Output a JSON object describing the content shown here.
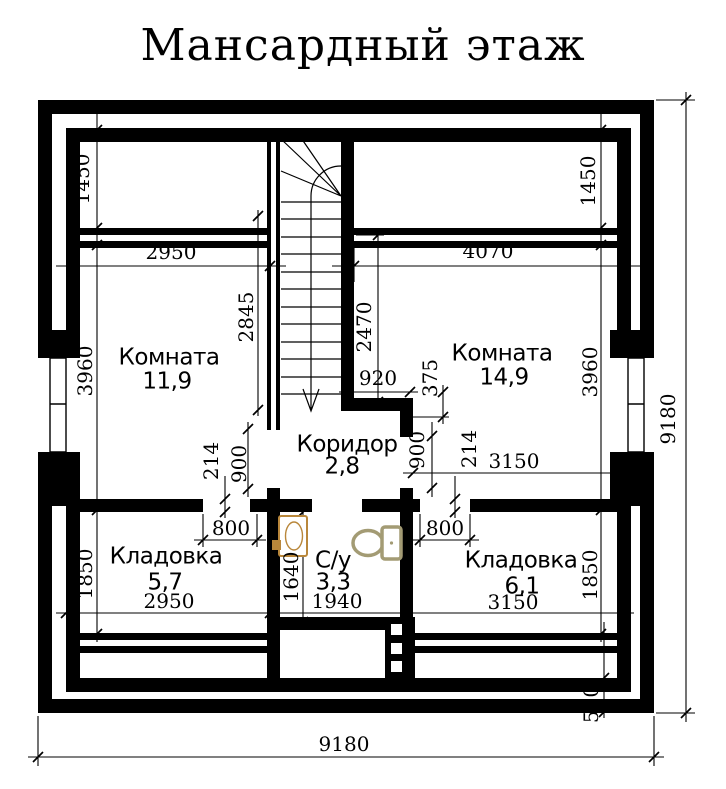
{
  "title": "Мансардный этаж",
  "rooms": {
    "room_left": {
      "name": "Комната",
      "area": "11,9"
    },
    "room_right": {
      "name": "Комната",
      "area": "14,9"
    },
    "corridor": {
      "name": "Коридор",
      "area": "2,8"
    },
    "bath": {
      "name": "С/у",
      "area": "3,3"
    },
    "storage_left": {
      "name": "Кладовка",
      "area": "5,7"
    },
    "storage_right": {
      "name": "Кладовка",
      "area": "6,1"
    }
  },
  "dims": {
    "dormer_left": "1450",
    "dormer_right": "1450",
    "room_left_width": "2950",
    "room_right_width": "4070",
    "room_left_depth": "3960",
    "room_right_depth": "3960",
    "stair_run": "2845",
    "stair_well": "2470",
    "stair_width": "920",
    "stair_return": "375",
    "door_left": "900",
    "wall_left": "214",
    "door_right": "900",
    "wall_right": "214",
    "room_right_lower_width": "3150",
    "storage_left_door": "800",
    "storage_right_door": "800",
    "storage_left_depth": "1850",
    "storage_right_depth": "1850",
    "bath_depth": "1640",
    "bath_width": "1940",
    "storage_left_width": "2950",
    "storage_right_width": "3150",
    "eaves": "500",
    "total_width": "9180",
    "total_depth": "9180"
  },
  "fixtures": {
    "sink": "sink",
    "toilet": "toilet"
  },
  "colors": {
    "ink": "#000000",
    "background": "#ffffff",
    "sink_accent": "#b9873b",
    "toilet_accent": "#a39b74"
  }
}
